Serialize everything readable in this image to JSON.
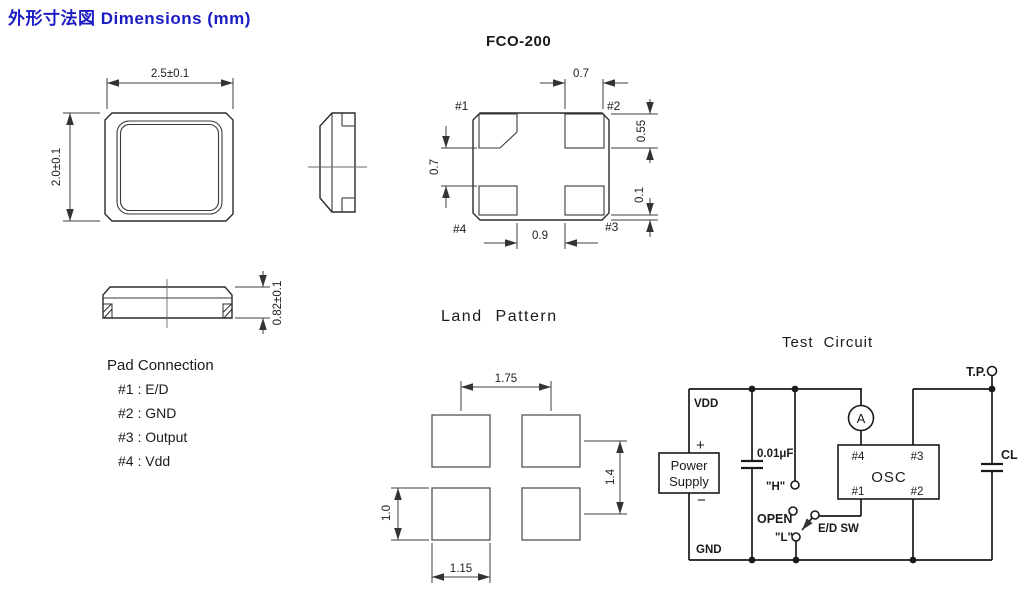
{
  "title": "外形寸法図  Dimensions (mm)",
  "colors": {
    "accent": "#1c1cc4",
    "ink": "#1a1a1a"
  },
  "package": {
    "name": "FCO-200",
    "top_view": {
      "width": "2.5±0.1",
      "height": "2.0±0.1"
    },
    "front_view": {
      "thickness": "0.82±0.1"
    },
    "bottom_view": {
      "pads": {
        "p1": "#1",
        "p2": "#2",
        "p3": "#3",
        "p4": "#4"
      },
      "dims": {
        "pad_width": "0.7",
        "pad_height": "0.55",
        "edge_gap": "0.1",
        "row_gap": "0.7",
        "col_gap": "0.9"
      }
    }
  },
  "pad_connection": {
    "title": "Pad Connection",
    "items": [
      "#1 : E/D",
      "#2 : GND",
      "#3 : Output",
      "#4 : Vdd"
    ]
  },
  "land_pattern": {
    "title": "Land  Pattern",
    "dims": {
      "col_pitch": "1.75",
      "row_pitch": "1.4",
      "pad_height": "1.0",
      "pad_width": "1.15"
    }
  },
  "test_circuit": {
    "title": "Test Circuit",
    "labels": {
      "vdd": "VDD",
      "gnd": "GND",
      "plus": "+",
      "minus": "−",
      "power_line1": "Power",
      "power_line2": "Supply",
      "bypass_cap": "0.01μF",
      "h_level": "\"H\"",
      "open": "OPEN",
      "l_level": "\"L\"",
      "ed_switch": "E/D SW",
      "ammeter": "A",
      "osc": "OSC",
      "pin1": "#1",
      "pin2": "#2",
      "pin3": "#3",
      "pin4": "#4",
      "test_point": "T.P.",
      "load_cap": "CL"
    }
  }
}
